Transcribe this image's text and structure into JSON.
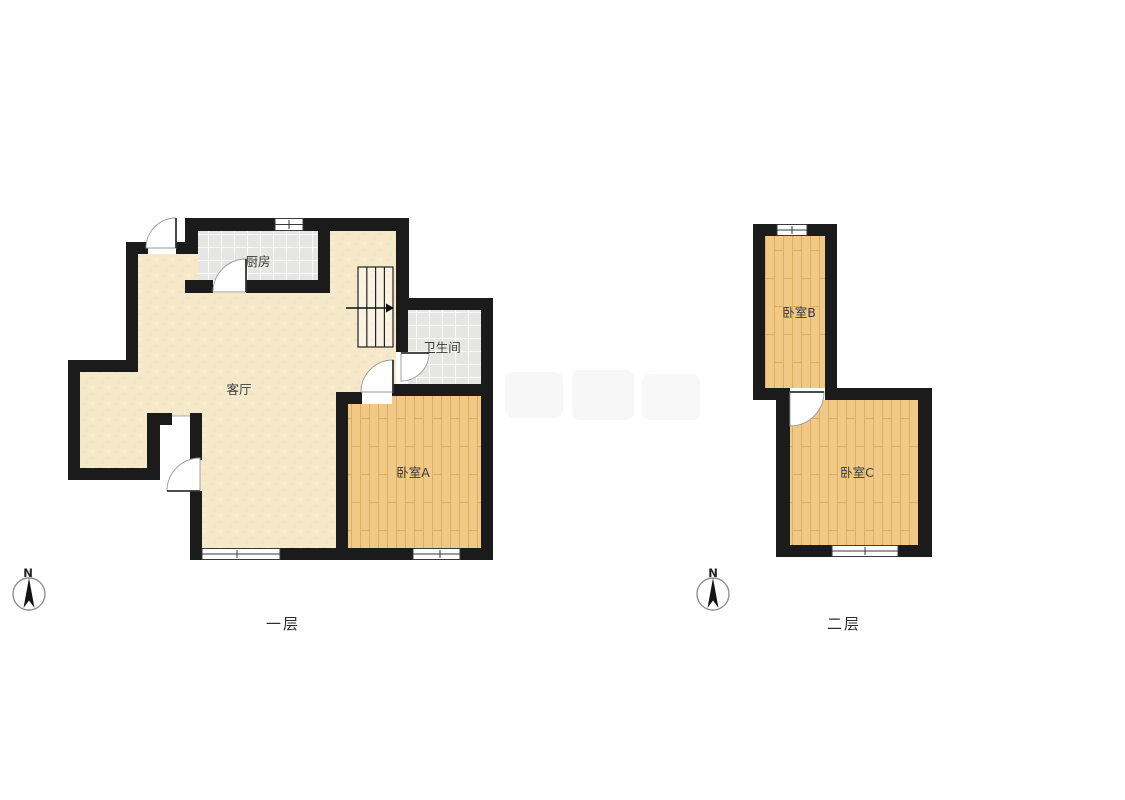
{
  "floor1": {
    "label": "一层",
    "compass": "N",
    "rooms": {
      "kitchen": "厨房",
      "living_room": "客厅",
      "bathroom": "卫生间",
      "bedroom_a": "卧室A"
    }
  },
  "floor2": {
    "label": "二层",
    "compass": "N",
    "rooms": {
      "bedroom_b": "卧室B",
      "bedroom_c": "卧室C"
    }
  },
  "colors": {
    "wall": "#1b1b1b",
    "wood_floor": "#f0c987",
    "wood_line": "#dcae63",
    "beige_floor": "#f6e9c9",
    "tile_floor": "#e6e6e4",
    "label_text": "#3a3a3a"
  }
}
